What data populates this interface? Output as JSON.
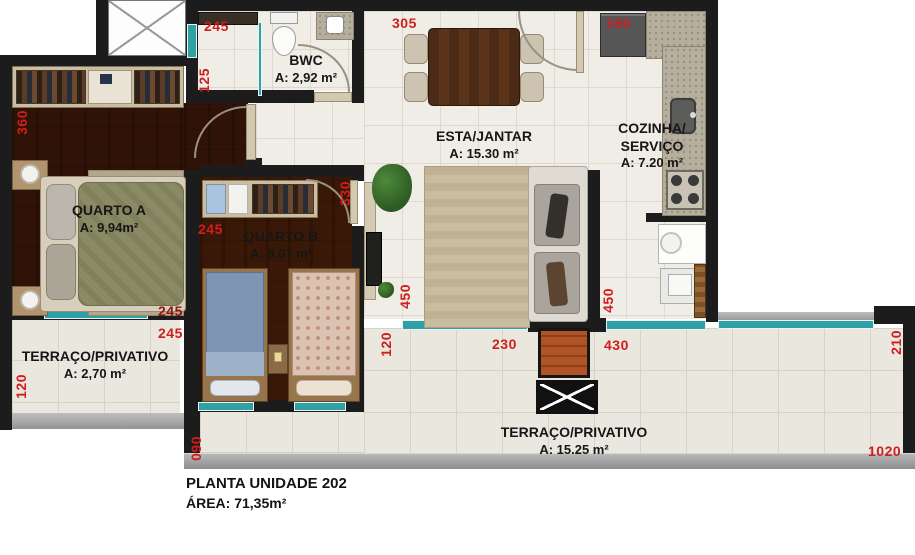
{
  "title": {
    "line1": "PLANTA UNIDADE 202",
    "line2": "ÁREA: 71,35m²"
  },
  "rooms": {
    "bwc": {
      "name": "BWC",
      "area": "A: 2,92 m²"
    },
    "esta_jantar": {
      "name": "ESTA/JANTAR",
      "area": "A: 15.30 m²"
    },
    "cozinha": {
      "name_line1": "COZINHA/",
      "name_line2": "SERVIÇO",
      "area": "A: 7.20 m²"
    },
    "quarto_a": {
      "name": "QUARTO A",
      "area": "A: 9,94m²"
    },
    "quarto_b": {
      "name": "QUARTO B",
      "area": "A: 8,07 m²"
    },
    "terraco_pequeno": {
      "name": "TERRAÇO/PRIVATIVO",
      "area": "A: 2,70 m²"
    },
    "terraco_grande": {
      "name": "TERRAÇO/PRIVATIVO",
      "area": "A: 15.25 m²"
    }
  },
  "dimensions": {
    "bwc_top": "245",
    "bwc_left": "125",
    "hall_top": "305",
    "kitchen_top": "160",
    "quarto_a_left": "360",
    "quarto_a_wall": "245",
    "quarto_a_window": "245",
    "quarto_b_left": "245",
    "quarto_b_right": "330",
    "terraco1_left": "120",
    "terrace_left_edge": "090",
    "quarto_b_bottom": "120",
    "living_terrace": "450",
    "terrace_mid": "230",
    "terrace_right_span": "430",
    "kitchen_terrace": "450",
    "terrace_right": "210",
    "terrace_bottom": "1020"
  },
  "colors": {
    "wall": "#1c1c1c",
    "dimension_red": "#cf1e1e",
    "wood_floor": "#6e4627",
    "tile_floor": "#f0ede6",
    "glass_teal": "#2fa0a5",
    "slab_gray": "#9e9e9e",
    "brick": "#a8502a"
  }
}
